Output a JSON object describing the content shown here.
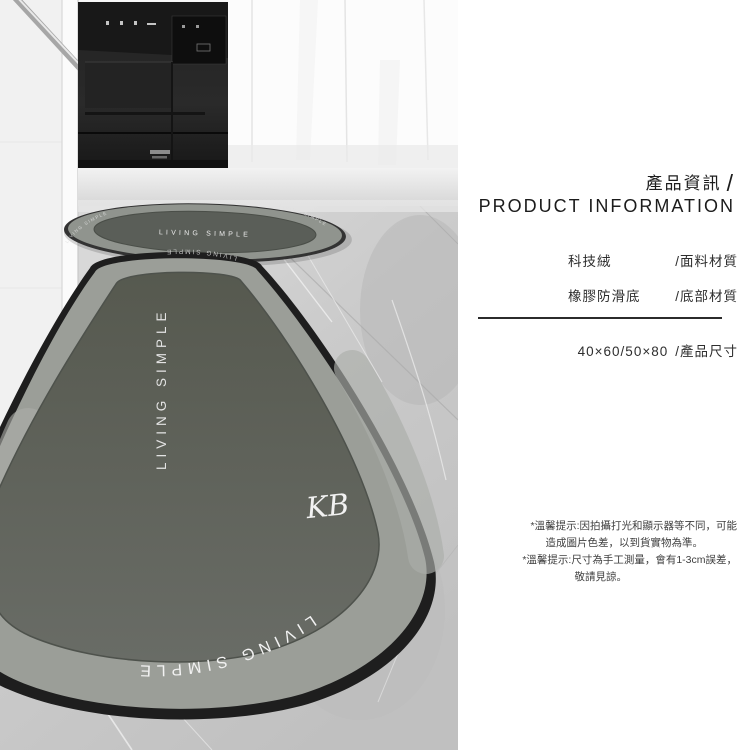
{
  "info_panel": {
    "title_zh": "產品資訊",
    "title_slash": "/",
    "title_en": "PRODUCT INFORMATION",
    "materials": [
      {
        "value": "科技絨",
        "label": "/面料材質"
      },
      {
        "value": "橡膠防滑底",
        "label": "/底部材質"
      }
    ],
    "size_value": "40×60/50×80",
    "size_label": "/產品尺寸",
    "tips": [
      [
        "*溫馨提示:因拍攝打光和顯示器等不同，可能",
        "造成圖片色差，以到貨實物為準。"
      ],
      [
        "*溫馨提示:尺寸為手工測量，會有1-3cm誤差，",
        "敬請見諒。"
      ]
    ]
  },
  "photo": {
    "small_mat": {
      "center_text": "LIVING SIMPLE",
      "ring_text": "LIVING SIMPLE"
    },
    "large_mat": {
      "vertical_text": "LIVING SIMPLE",
      "edge_text": "LIVING SIMPLE",
      "top_edge_text": "LIVING SIMPLE",
      "signature": "KB"
    }
  },
  "colors": {
    "mat_inner": "#5d605a",
    "mat_band": "#9b9e98",
    "mat_edge": "#1e1e1e",
    "text_primary": "#222222",
    "divider": "#2b2b2b"
  }
}
